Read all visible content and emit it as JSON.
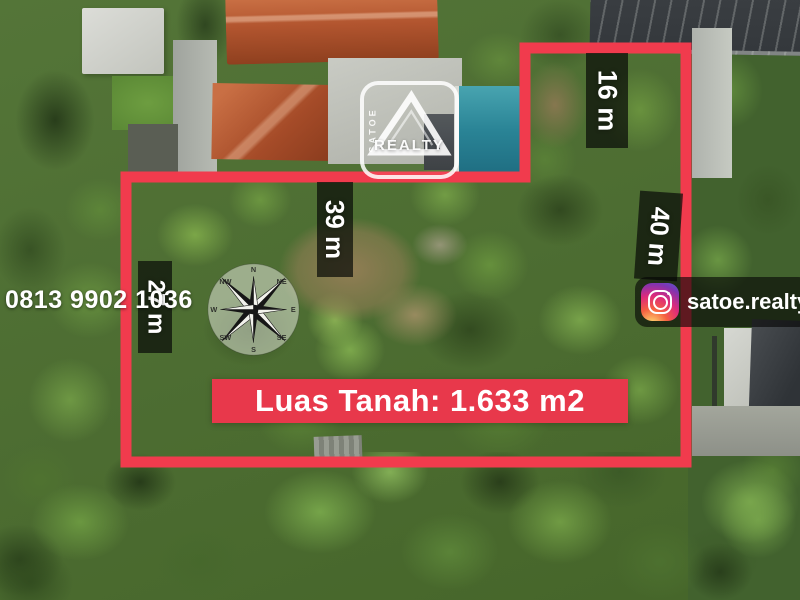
{
  "branding": {
    "logo_vertical_text": "SATOE",
    "logo_horizontal_text": "REALTY"
  },
  "contact": {
    "phone_number": "0813 9902 1036",
    "instagram_handle": "satoe.realty"
  },
  "land_plot": {
    "area_label": "Luas Tanah: 1.633 m2",
    "dimension_labels": {
      "top_segment": "16 m",
      "right_segment": "40 m",
      "upper_inner_segment": "39 m",
      "left_segment": "27 m"
    }
  },
  "compass_points": [
    "N",
    "NE",
    "E",
    "SE",
    "S",
    "SW",
    "W",
    "NW"
  ],
  "colors": {
    "boundary_red": "#f13b4d",
    "banner_red": "#e8384b",
    "label_background": "rgba(10,12,8,0.72)",
    "text_white": "#ffffff"
  }
}
